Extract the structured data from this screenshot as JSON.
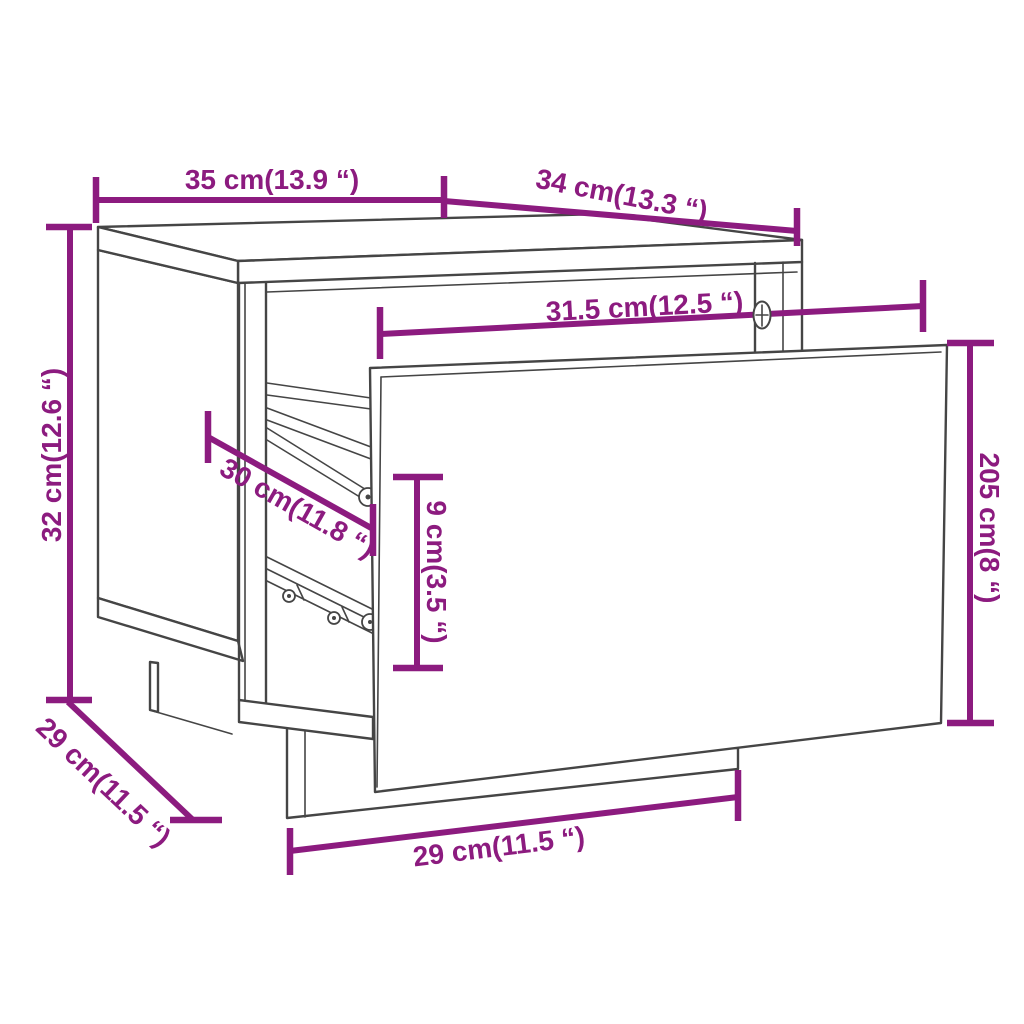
{
  "colors": {
    "dimension": "#8C1B7F",
    "line_art": "#454545",
    "background": "#FFFFFF"
  },
  "diagram_type": "furniture-dimension-line-drawing",
  "object": "nightstand-with-open-drawer",
  "dimensions": [
    {
      "id": "top-width",
      "label": "35 cm(13.9 “)",
      "cm": "35",
      "inch": "13.9",
      "placement": "top-horizontal"
    },
    {
      "id": "top-depth",
      "label": "34 cm(13.3 “)",
      "cm": "34",
      "inch": "13.3",
      "placement": "top-right-diagonal"
    },
    {
      "id": "overall-height",
      "label": "32 cm(12.6 “)",
      "cm": "32",
      "inch": "12.6",
      "placement": "left-vertical"
    },
    {
      "id": "inner-width",
      "label": "31.5 cm(12.5 “)",
      "cm": "31.5",
      "inch": "12.5",
      "placement": "middle-horizontal"
    },
    {
      "id": "drawer-front-height",
      "label": "205 cm(8 “)",
      "cm": "205",
      "inch": "8",
      "placement": "right-vertical"
    },
    {
      "id": "inner-depth",
      "label": "30 cm(11.8 “)",
      "cm": "30",
      "inch": "11.8",
      "placement": "inner-diagonal"
    },
    {
      "id": "drawer-inner-height",
      "label": "9 cm(3.5 “)",
      "cm": "9",
      "inch": "3.5",
      "placement": "inner-vertical"
    },
    {
      "id": "base-depth",
      "label": "29 cm(11.5 “)",
      "cm": "29",
      "inch": "11.5",
      "placement": "bottom-left-diagonal"
    },
    {
      "id": "base-width",
      "label": "29 cm(11.5 “)",
      "cm": "29",
      "inch": "11.5",
      "placement": "bottom-horizontal"
    }
  ]
}
